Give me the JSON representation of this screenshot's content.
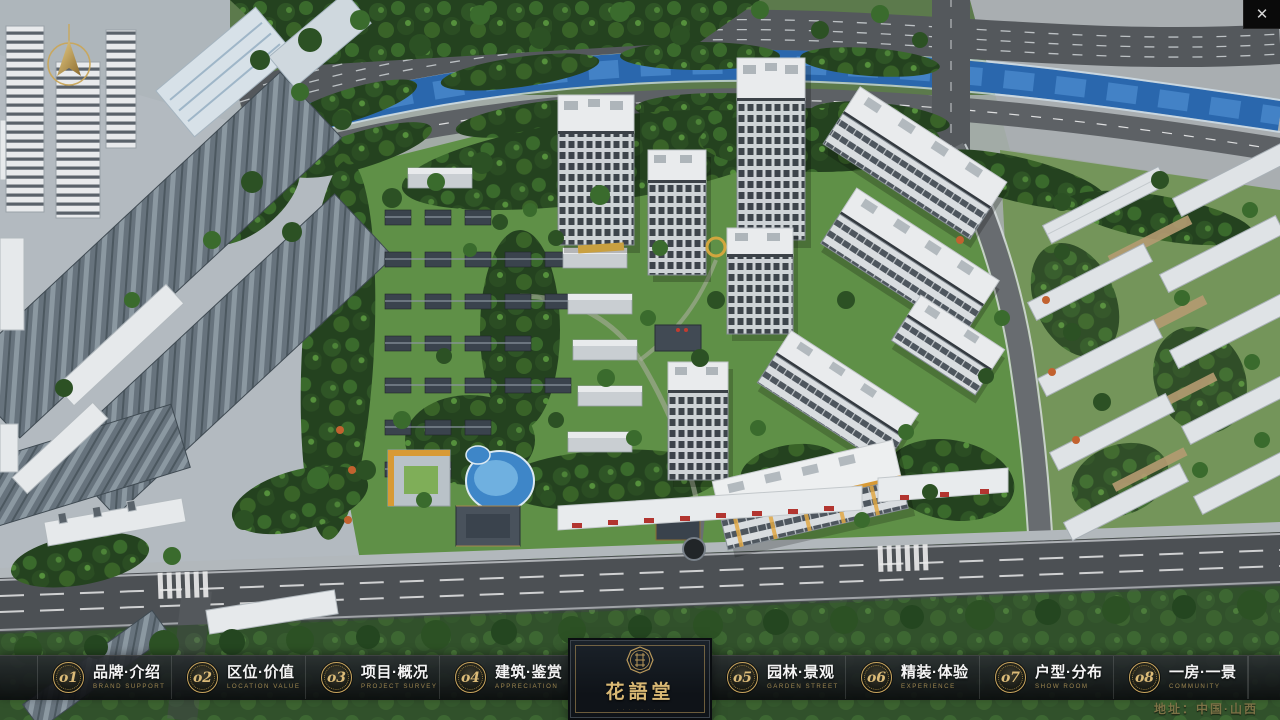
{
  "window_controls": {
    "close": "✕"
  },
  "logo": {
    "title": "花語堂",
    "tagline": "· · · · · · · ·"
  },
  "menu": {
    "items": [
      {
        "num": "o1",
        "cn": "品牌·介绍",
        "en": "BRAND SUPPORT"
      },
      {
        "num": "o2",
        "cn": "区位·价值",
        "en": "LOCATION VALUE"
      },
      {
        "num": "o3",
        "cn": "项目·概况",
        "en": "PROJECT SURVEY"
      },
      {
        "num": "o4",
        "cn": "建筑·鉴赏",
        "en": "APPRECIATION"
      },
      {
        "num": "o5",
        "cn": "园林·景观",
        "en": "GARDEN STREET"
      },
      {
        "num": "o6",
        "cn": "精装·体验",
        "en": "EXPERIENCE"
      },
      {
        "num": "o7",
        "cn": "户型·分布",
        "en": "SHOW ROOM"
      },
      {
        "num": "o8",
        "cn": "一房·一景",
        "en": "COMMUNITY"
      }
    ]
  },
  "footer": {
    "address": "地址：中国·山西"
  },
  "colors": {
    "gold": "#c9a55e",
    "bar_bg": "#101214",
    "river": "#2a67ad",
    "road": "#54585c"
  }
}
